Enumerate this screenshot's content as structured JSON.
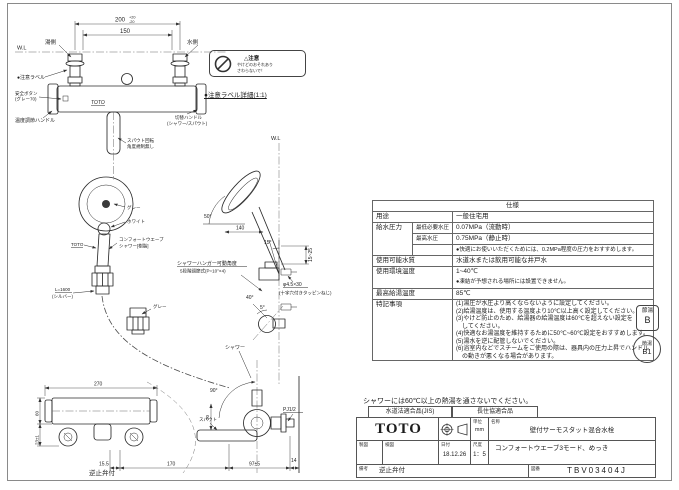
{
  "sheet": {
    "caution_note": "シャワーには60℃以上の熱湯を通さないでください。"
  },
  "front_view": {
    "dim_pitch": "200",
    "dim_pitch_tol_up": "+20",
    "dim_pitch_tol_dn": "-20",
    "dim_inner": "150",
    "wl": "W.L",
    "hot_label": "湯側",
    "cold_label": "水側",
    "caution_label": "●注意ラベル",
    "safety_button_1": "安全ボタン",
    "safety_button_2": "(グレー70)",
    "temp_handle": "温度調節ハンドル",
    "brand": "TOTO",
    "switch_handle_1": "切替ハンドル",
    "switch_handle_2": "(シャワー/スパウト)",
    "spout_note_1": "スパウト回転",
    "spout_note_2": "角度規制無し",
    "head_gray": "グレー",
    "head_white": "ホワイト",
    "head_brand": "TOTO",
    "shower_name_1": "コンフォートウエーブ",
    "shower_name_2": "シャワー[樹脂]",
    "hose_len": "L=1600",
    "hose_color": "(シルバー)",
    "hanger_gray": "グレー",
    "hanger_note_1": "シャワーハンガー可動角度",
    "hanger_note_2": "5段階調節式(P=10°×4)"
  },
  "side_view": {
    "wl": "W.L",
    "angle_head": "50°",
    "dim_reach": "140",
    "angle_hanger": "15°",
    "dim_height": "15~25",
    "screw_1": "φ4.5×30",
    "screw_2": "(十字穴付きタッピンねじ)",
    "angle_down": "40°",
    "angle_small": "5°"
  },
  "caution_detail": {
    "caption": "●注意ラベル詳細(1:1)",
    "title": "△注意",
    "line1": "やけどのおそれあり",
    "line2": "さわらないで！"
  },
  "plan_view": {
    "shower_label": "シャワー",
    "angle_swing": "90°",
    "dim_width": "270",
    "dim_depth": "60",
    "dim_offset": "23±1",
    "dim_a": "15.5",
    "dim_b": "170",
    "dim_c": "97±5",
    "dim_d": "14",
    "dim_e": "20",
    "spout_label": "スパウト",
    "thread_label": "PJ1/2",
    "remark": "逆止弁付"
  },
  "spec_table": {
    "title": "仕様",
    "usage_label": "用途",
    "usage_value": "一般住宅用",
    "pressure_label": "給水圧力",
    "pressure_min_label": "最低必要水圧",
    "pressure_min_value": "0.07MPa（流動時）",
    "pressure_max_label": "最高水圧",
    "pressure_max_value": "0.75MPa（静止時）",
    "pressure_note": "●快適にお使いいただくためには、0.2MPa程度の圧力をおすすめします。",
    "water_label": "使用可能水質",
    "water_value": "水道水または飲用可能な井戸水",
    "env_label": "使用環境温度",
    "env_value": "1~40℃",
    "env_note": "●凍結が予想される場所には設置できません。",
    "hot_label": "最高給湯温度",
    "hot_value": "85℃",
    "notes_label": "特記事項",
    "notes": [
      "(1)湯圧が水圧より高くならないように設定してください。",
      "(2)給湯温度は、使用する温度より10℃以上高く設定してください。",
      "(3)やけど防止のため、給湯器の給湯温度は60℃を超えない設定を",
      "　してください。",
      "(4)快適なお湯温度を維持するために50℃~60℃設定をおすすめします。",
      "(5)湯水を逆に配管しないでください。",
      "(6)浴室内などでスチームをご使用の際は、器具内の圧力上昇でハンドル",
      "　の動きが悪くなる場合があります。"
    ]
  },
  "badges": {
    "b_top": "節湯",
    "b_bottom": "B",
    "b1_top": "節湯",
    "b1_bottom": "B1"
  },
  "title_block": {
    "jis": "水道法適合品(JIS)",
    "association": "長住協適合品",
    "brand": "TOTO",
    "unit_label": "単位",
    "unit_value": "mm",
    "name_label": "名称",
    "name_value": "壁付サーモスタット混合水栓",
    "draft_label": "製図",
    "check_label": "検図",
    "date_label": "日付",
    "date_value": "18.12.26",
    "scale_label": "尺度",
    "scale_value": "1：5",
    "description": "コンフォートウエーブ3モード、めっき",
    "remarks_label": "備考",
    "remarks_value": "逆止弁付",
    "number_label": "図番",
    "number_value": "TBV03404J"
  }
}
